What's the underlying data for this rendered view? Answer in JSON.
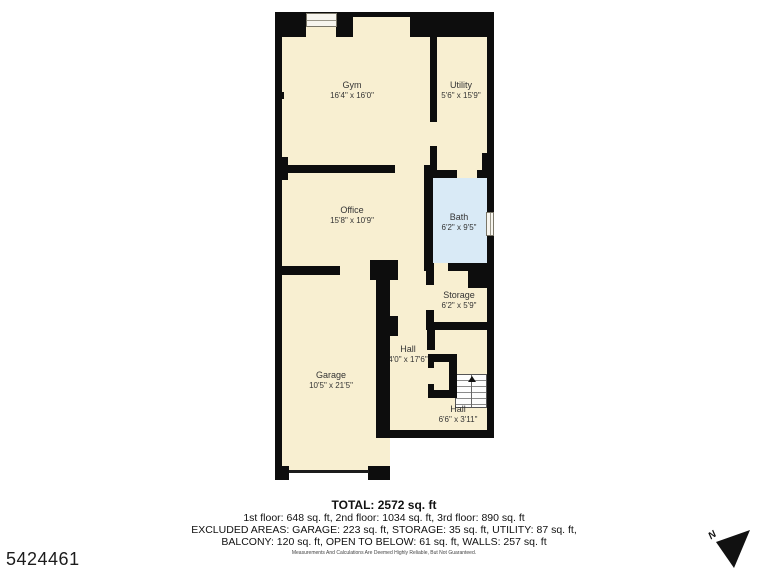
{
  "floor_plan": {
    "colors": {
      "wall": "#0d0d0d",
      "room_fill": "#F8EFD1",
      "bath_fill": "#D9EAF6"
    },
    "rooms": [
      {
        "key": "gym",
        "name": "Gym",
        "dims": "16'4\" x 16'0\""
      },
      {
        "key": "utility",
        "name": "Utility",
        "dims": "5'6\" x 15'9\""
      },
      {
        "key": "office",
        "name": "Office",
        "dims": "15'8\" x 10'9\""
      },
      {
        "key": "bath",
        "name": "Bath",
        "dims": "6'2\" x 9'5\""
      },
      {
        "key": "storage",
        "name": "Storage",
        "dims": "6'2\" x 5'9\""
      },
      {
        "key": "hall_upper",
        "name": "Hall",
        "dims": "4'0\" x 17'6\""
      },
      {
        "key": "garage",
        "name": "Garage",
        "dims": "10'5\" x 21'5\""
      },
      {
        "key": "hall_lower",
        "name": "Hall",
        "dims": "6'6\" x 3'11\""
      }
    ],
    "compass_label": "N"
  },
  "summary": {
    "total": "TOTAL: 2572 sq. ft",
    "floors_line": "1st floor: 648 sq. ft, 2nd floor: 1034 sq. ft, 3rd floor: 890 sq. ft",
    "excluded_line1": "EXCLUDED AREAS: GARAGE: 223 sq. ft, STORAGE: 35 sq. ft, UTILITY: 87 sq. ft,",
    "excluded_line2": "BALCONY: 120 sq. ft, OPEN TO BELOW: 61 sq. ft, WALLS: 257 sq. ft",
    "disclaimer": "Measurements And Calculations Are Deemed Highly Reliable, But Not Guaranteed."
  },
  "listing_id": "5424461"
}
